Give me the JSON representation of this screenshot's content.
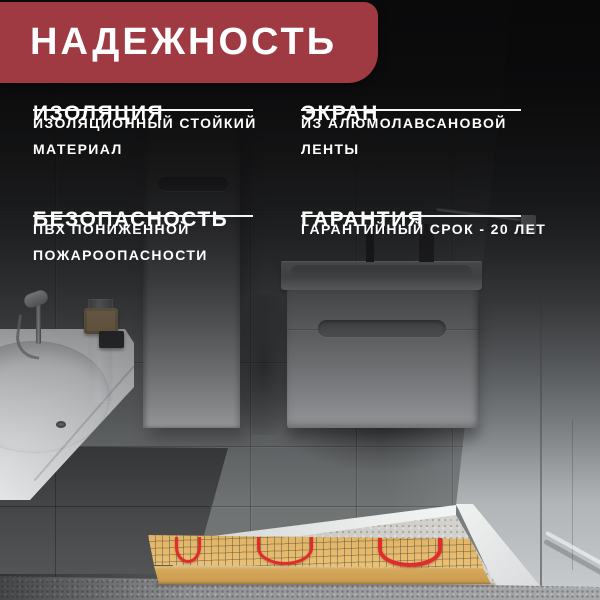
{
  "banner": {
    "title": "НАДЕЖНОСТЬ"
  },
  "features": [
    {
      "title": "ИЗОЛЯЦИЯ",
      "description": "ИЗОЛЯЦИОННЫЙ СТОЙКИЙ МАТЕРИАЛ"
    },
    {
      "title": "ЭКРАН",
      "description": "ИЗ АЛЮМОЛАВСАНОВОЙ ЛЕНТЫ"
    },
    {
      "title": "БЕЗОПАСНОСТЬ",
      "description": "ПВХ ПОНИЖЕННОЙ ПОЖАРООПАСНОСТИ"
    },
    {
      "title": "ГАРАНТИЯ",
      "description": "ГАРАНТИЙНЫЙ СРОК - 20 ЛЕТ"
    }
  ],
  "colors": {
    "banner-red": "#A03A42",
    "cable-red": "#E22B2E",
    "mat-tan": "#E0B365",
    "mat-front": "#D5A85C",
    "underline": "#F4F5F5",
    "text": "#FFFFFF"
  }
}
